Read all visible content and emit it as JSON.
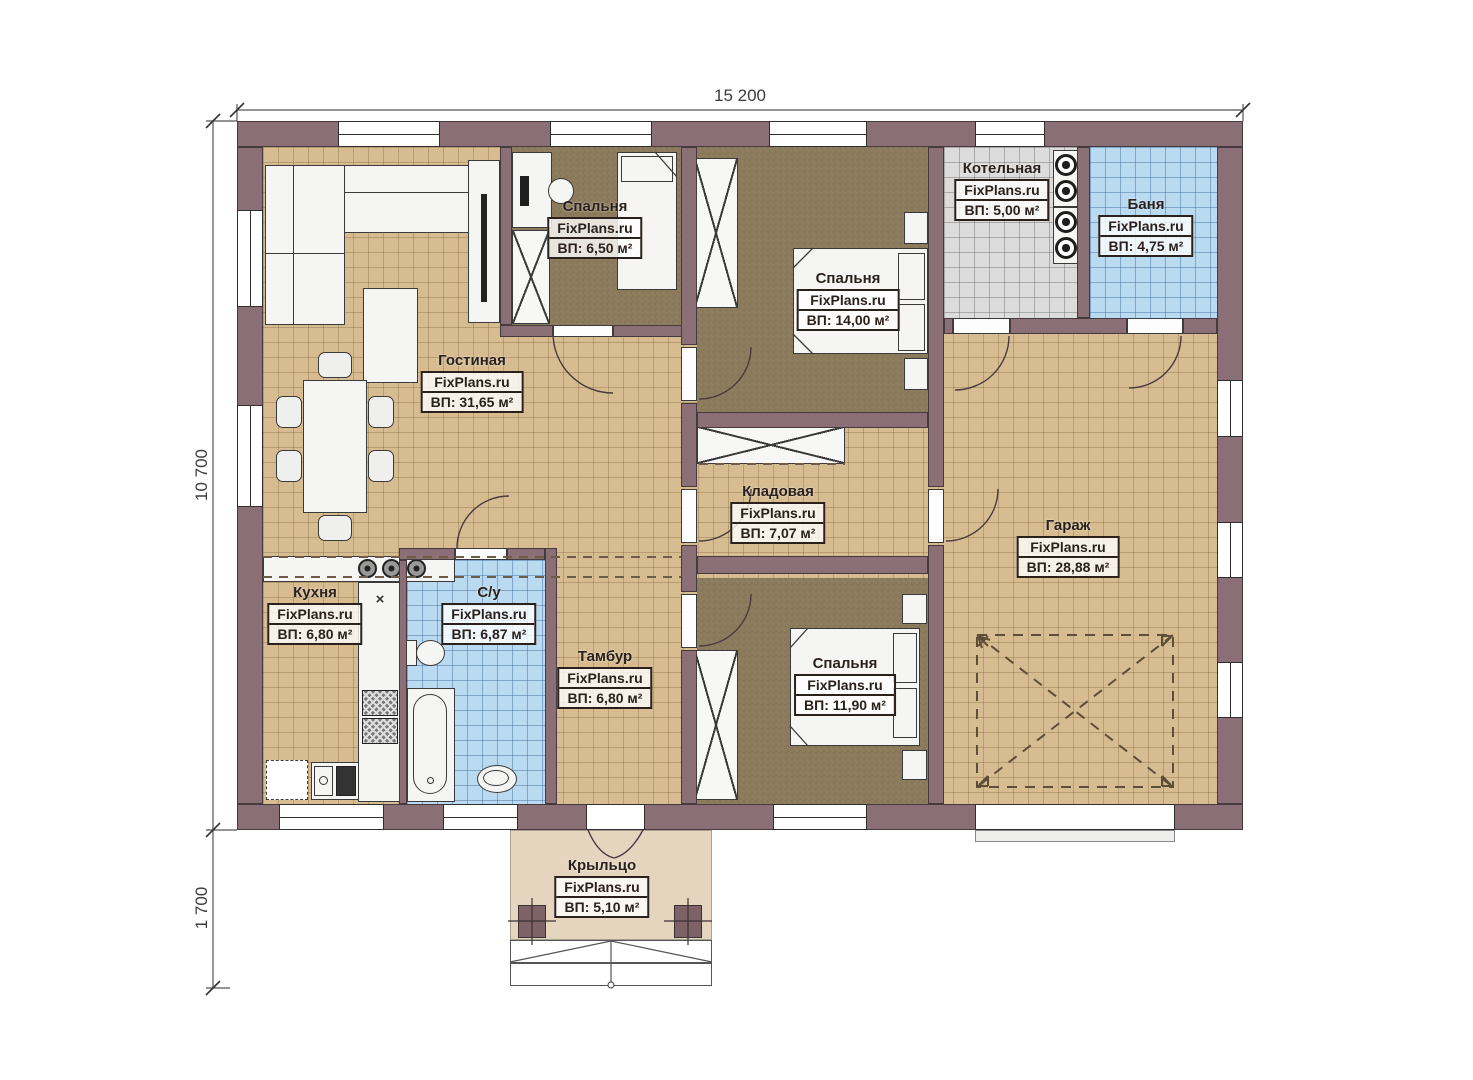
{
  "meta": {
    "watermark": "FixPlans.ru"
  },
  "dimensions": {
    "width": "15 200",
    "height": "10 700",
    "porch": "1 700"
  },
  "rooms": [
    {
      "name": "Гостиная",
      "area": "ВП: 31,65 м²"
    },
    {
      "name": "Спальня",
      "area": "ВП: 6,50 м²"
    },
    {
      "name": "Спальня",
      "area": "ВП: 14,00 м²"
    },
    {
      "name": "Котельная",
      "area": "ВП: 5,00 м²"
    },
    {
      "name": "Баня",
      "area": "ВП: 4,75 м²"
    },
    {
      "name": "Кладовая",
      "area": "ВП: 7,07 м²"
    },
    {
      "name": "Гараж",
      "area": "ВП: 28,88 м²"
    },
    {
      "name": "Кухня",
      "area": "ВП: 6,80 м²"
    },
    {
      "name": "С/у",
      "area": "ВП: 6,87 м²"
    },
    {
      "name": "Тамбур",
      "area": "ВП: 6,80 м²"
    },
    {
      "name": "Спальня",
      "area": "ВП: 11,90 м²"
    },
    {
      "name": "Крыльцо",
      "area": "ВП: 5,10 м²"
    }
  ],
  "colors": {
    "wall": "#8a7076",
    "floor_beige": "#d6bc90",
    "floor_dark": "#8d7c5d",
    "floor_blue": "#b9daf0",
    "floor_gray": "#dcdcdc",
    "porch": "#e5d5bf"
  }
}
